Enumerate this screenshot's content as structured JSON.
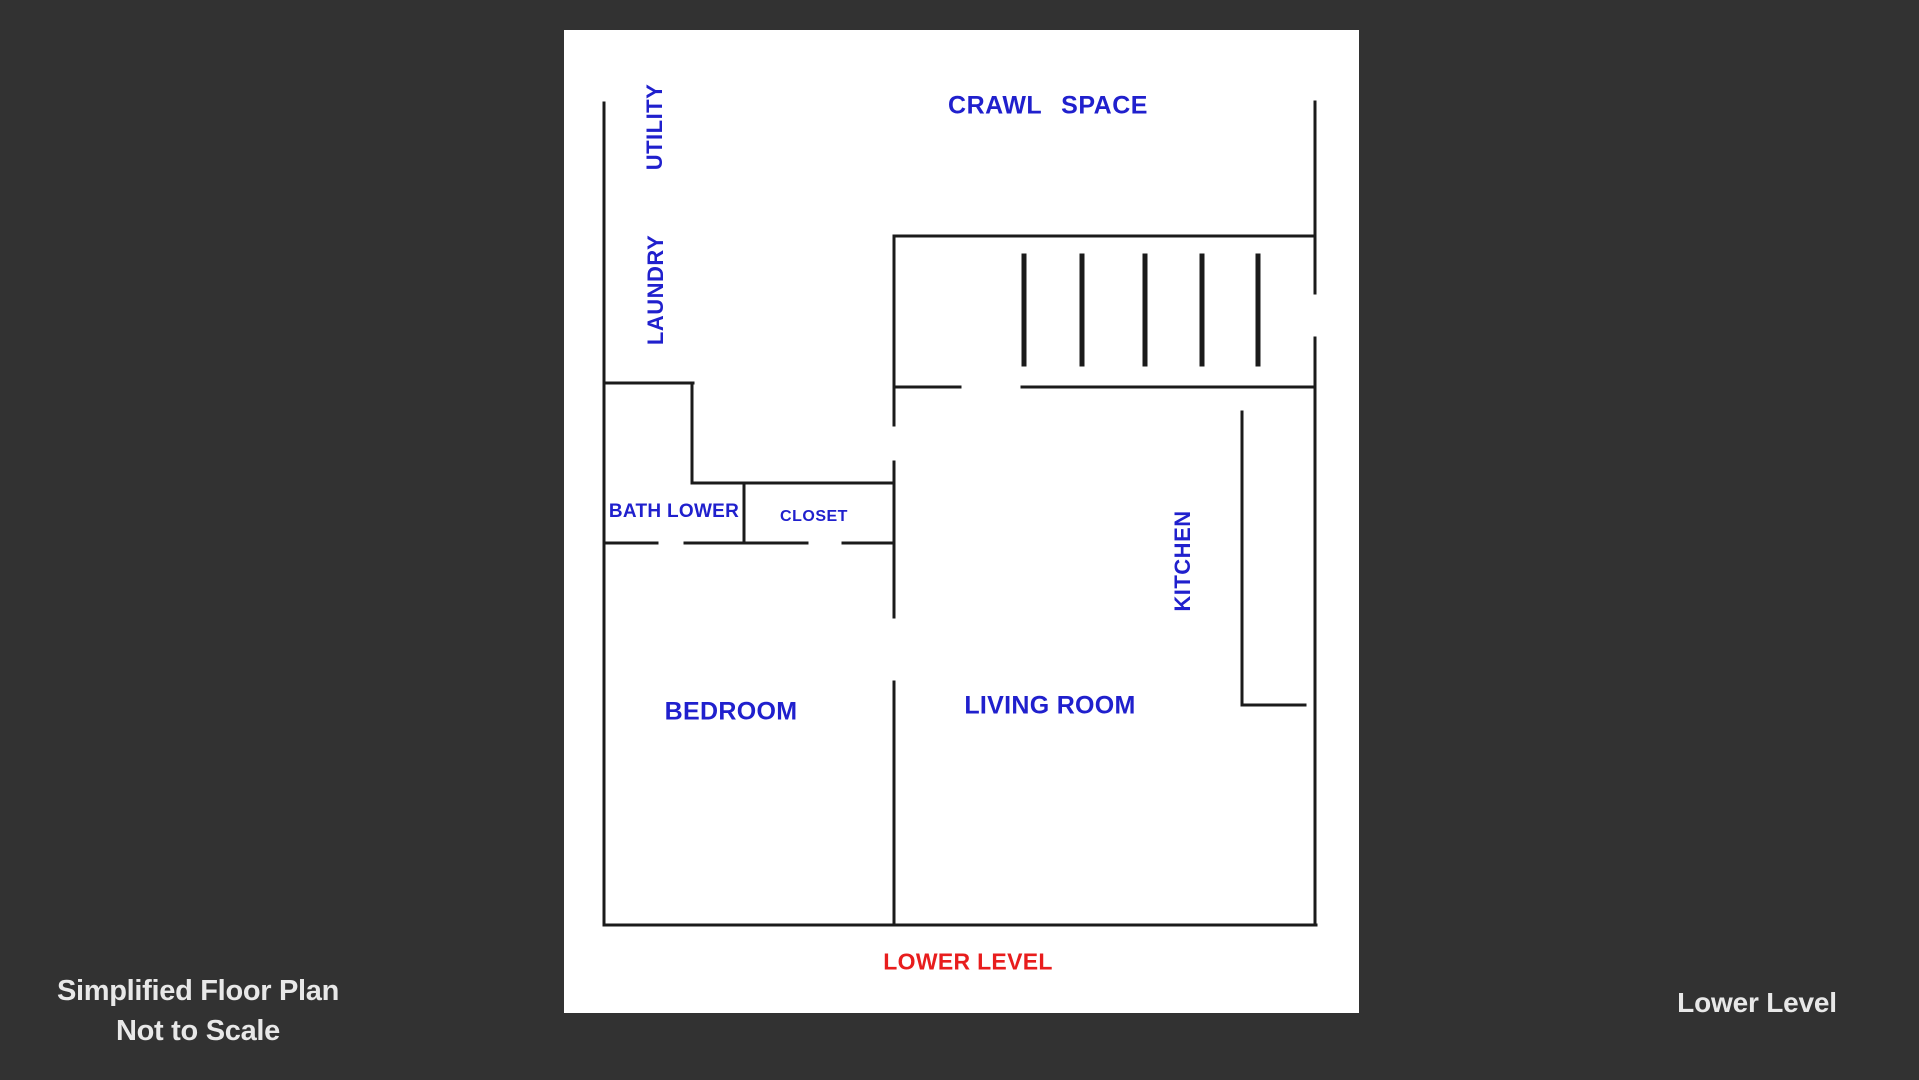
{
  "theme": {
    "bg": "#323232",
    "paper": "#ffffff",
    "wall": "#1b1b1b",
    "label_blue": "#2020cd",
    "label_red": "#e81d1d",
    "footer_text": "#e8e8e8"
  },
  "floor_plan": {
    "labels": {
      "crawl_space": "CRAWL SPACE",
      "utility": "UTILITY",
      "laundry": "LAUNDRY",
      "bath_lower": "BATH LOWER",
      "closet": "CLOSET",
      "kitchen": "KITCHEN",
      "bedroom": "BEDROOM",
      "living_room": "LIVING ROOM",
      "lower_level": "LOWER LEVEL"
    },
    "wall_thickness": 3,
    "walls": [
      {
        "name": "left-wall",
        "x1": 604,
        "y1": 103,
        "x2": 604,
        "y2": 925
      },
      {
        "name": "bottom-wall",
        "x1": 604,
        "y1": 925,
        "x2": 1316,
        "y2": 925
      },
      {
        "name": "right-wall-upper",
        "x1": 1315,
        "y1": 102,
        "x2": 1315,
        "y2": 293
      },
      {
        "name": "right-wall-lower",
        "x1": 1315,
        "y1": 338,
        "x2": 1315,
        "y2": 925
      },
      {
        "name": "stair-room-top",
        "x1": 894,
        "y1": 236,
        "x2": 1315,
        "y2": 236
      },
      {
        "name": "stair-room-left",
        "x1": 894,
        "y1": 236,
        "x2": 894,
        "y2": 425
      },
      {
        "name": "stair-room-bottom-left",
        "x1": 894,
        "y1": 387,
        "x2": 960,
        "y2": 387
      },
      {
        "name": "stair-room-bottom-right",
        "x1": 1022,
        "y1": 387,
        "x2": 1315,
        "y2": 387
      },
      {
        "name": "laundry-bath-wall-h",
        "x1": 604,
        "y1": 383,
        "x2": 693,
        "y2": 383
      },
      {
        "name": "laundry-bath-wall-v",
        "x1": 692,
        "y1": 383,
        "x2": 692,
        "y2": 483
      },
      {
        "name": "closet-top-wall",
        "x1": 692,
        "y1": 483,
        "x2": 894,
        "y2": 483
      },
      {
        "name": "bath-closet-divider",
        "x1": 744,
        "y1": 483,
        "x2": 744,
        "y2": 543
      },
      {
        "name": "bedroom-top-wall-1",
        "x1": 604,
        "y1": 543,
        "x2": 657,
        "y2": 543
      },
      {
        "name": "bedroom-top-wall-2",
        "x1": 685,
        "y1": 543,
        "x2": 807,
        "y2": 543
      },
      {
        "name": "bedroom-top-wall-3",
        "x1": 843,
        "y1": 543,
        "x2": 894,
        "y2": 543
      },
      {
        "name": "center-divider-mid",
        "x1": 894,
        "y1": 462,
        "x2": 894,
        "y2": 617
      },
      {
        "name": "center-divider-lower",
        "x1": 894,
        "y1": 682,
        "x2": 894,
        "y2": 925
      },
      {
        "name": "kitchen-counter-v",
        "x1": 1242,
        "y1": 412,
        "x2": 1242,
        "y2": 705
      },
      {
        "name": "kitchen-counter-h",
        "x1": 1242,
        "y1": 705,
        "x2": 1305,
        "y2": 705
      }
    ],
    "stair_treads": {
      "x_positions": [
        1024,
        1082,
        1145,
        1202,
        1258
      ],
      "y1": 256,
      "y2": 364,
      "thickness": 5
    }
  },
  "footer": {
    "note_line1": "Simplified Floor Plan",
    "note_line2": "Not to Scale",
    "level_caption": "Lower Level"
  }
}
